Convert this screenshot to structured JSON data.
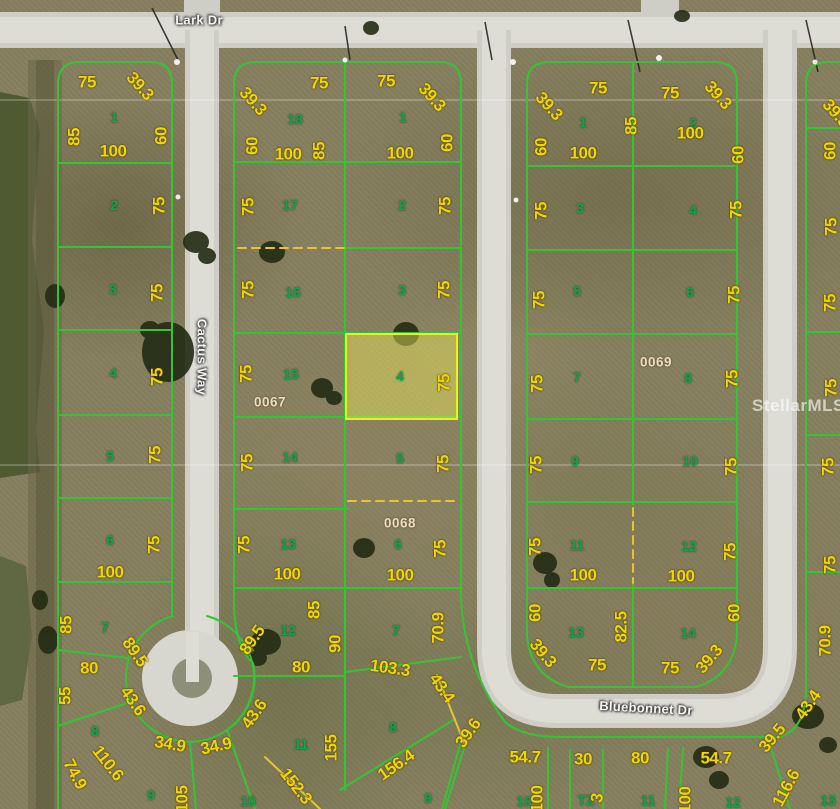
{
  "map": {
    "description": "Aerial parcel plat map with lot boundaries and dimensions",
    "colors": {
      "lot_line": "#35c435",
      "dimension_text": "#f2d600",
      "lot_number_text": "#0fa352",
      "road": "#d8d7cf",
      "dashed_line": "#e8c52e",
      "highlight_fill": "rgba(235,233,90,0.45)",
      "highlight_border": "#eeee22",
      "terrain": "#87805f",
      "water": "#4f5a33"
    },
    "streets": [
      {
        "text": "Lark Dr",
        "x": 199,
        "y": 20,
        "rot": 0
      },
      {
        "text": "Cactus Way",
        "x": 202,
        "y": 357,
        "rot": 90
      },
      {
        "text": "Bluebonnet Dr",
        "x": 646,
        "y": 708,
        "rot": 3
      }
    ],
    "block_ids": [
      {
        "text": "0067",
        "x": 270,
        "y": 402
      },
      {
        "text": "0068",
        "x": 400,
        "y": 523
      },
      {
        "text": "0069",
        "x": 656,
        "y": 362
      }
    ],
    "watermark": {
      "text": "StellarMLS",
      "x": 752,
      "y": 406
    },
    "highlight": {
      "lot": "4",
      "x": 345,
      "y": 333,
      "w": 113,
      "h": 87
    },
    "lot_numbers": [
      {
        "text": "1",
        "x": 114,
        "y": 117
      },
      {
        "text": "2",
        "x": 114,
        "y": 205
      },
      {
        "text": "3",
        "x": 113,
        "y": 289
      },
      {
        "text": "4",
        "x": 113,
        "y": 373
      },
      {
        "text": "5",
        "x": 110,
        "y": 456
      },
      {
        "text": "6",
        "x": 110,
        "y": 540
      },
      {
        "text": "7",
        "x": 105,
        "y": 627
      },
      {
        "text": "8",
        "x": 95,
        "y": 731
      },
      {
        "text": "9",
        "x": 151,
        "y": 795
      },
      {
        "text": "10",
        "x": 248,
        "y": 801
      },
      {
        "text": "18",
        "x": 295,
        "y": 119
      },
      {
        "text": "17",
        "x": 290,
        "y": 205
      },
      {
        "text": "16",
        "x": 293,
        "y": 292
      },
      {
        "text": "15",
        "x": 291,
        "y": 374
      },
      {
        "text": "14",
        "x": 290,
        "y": 457
      },
      {
        "text": "13",
        "x": 288,
        "y": 544
      },
      {
        "text": "12",
        "x": 288,
        "y": 630
      },
      {
        "text": "11",
        "x": 301,
        "y": 744
      },
      {
        "text": "1",
        "x": 403,
        "y": 117
      },
      {
        "text": "2",
        "x": 402,
        "y": 205
      },
      {
        "text": "3",
        "x": 402,
        "y": 290
      },
      {
        "text": "4",
        "x": 400,
        "y": 376
      },
      {
        "text": "5",
        "x": 400,
        "y": 458
      },
      {
        "text": "6",
        "x": 398,
        "y": 544
      },
      {
        "text": "7",
        "x": 396,
        "y": 630
      },
      {
        "text": "8",
        "x": 393,
        "y": 727
      },
      {
        "text": "1",
        "x": 583,
        "y": 122
      },
      {
        "text": "2",
        "x": 693,
        "y": 123
      },
      {
        "text": "3",
        "x": 580,
        "y": 208
      },
      {
        "text": "4",
        "x": 693,
        "y": 210
      },
      {
        "text": "5",
        "x": 577,
        "y": 291
      },
      {
        "text": "6",
        "x": 690,
        "y": 292
      },
      {
        "text": "7",
        "x": 577,
        "y": 377
      },
      {
        "text": "8",
        "x": 688,
        "y": 378
      },
      {
        "text": "9",
        "x": 575,
        "y": 461
      },
      {
        "text": "10",
        "x": 690,
        "y": 461
      },
      {
        "text": "11",
        "x": 577,
        "y": 545
      },
      {
        "text": "12",
        "x": 689,
        "y": 546
      },
      {
        "text": "13",
        "x": 576,
        "y": 632
      },
      {
        "text": "14",
        "x": 688,
        "y": 633
      },
      {
        "text": "9",
        "x": 428,
        "y": 798
      },
      {
        "text": "10",
        "x": 524,
        "y": 801
      },
      {
        "text": "TZ",
        "x": 586,
        "y": 800
      },
      {
        "text": "11",
        "x": 648,
        "y": 800
      },
      {
        "text": "12",
        "x": 733,
        "y": 802
      },
      {
        "text": "13",
        "x": 828,
        "y": 800
      }
    ],
    "dimensions": [
      {
        "text": "75",
        "x": 87,
        "y": 82,
        "rot": 0
      },
      {
        "text": "39.3",
        "x": 140,
        "y": 86,
        "rot": 48
      },
      {
        "text": "85",
        "x": 74,
        "y": 137,
        "rot": -90
      },
      {
        "text": "100",
        "x": 113,
        "y": 151,
        "rot": 0
      },
      {
        "text": "60",
        "x": 161,
        "y": 136,
        "rot": -90
      },
      {
        "text": "75",
        "x": 159,
        "y": 206,
        "rot": -90
      },
      {
        "text": "75",
        "x": 157,
        "y": 293,
        "rot": -90
      },
      {
        "text": "75",
        "x": 157,
        "y": 377,
        "rot": -90
      },
      {
        "text": "75",
        "x": 155,
        "y": 455,
        "rot": -90
      },
      {
        "text": "75",
        "x": 154,
        "y": 545,
        "rot": -90
      },
      {
        "text": "100",
        "x": 110,
        "y": 572,
        "rot": 0
      },
      {
        "text": "85",
        "x": 66,
        "y": 625,
        "rot": -90
      },
      {
        "text": "80",
        "x": 89,
        "y": 668,
        "rot": 0
      },
      {
        "text": "89.5",
        "x": 135,
        "y": 652,
        "rot": 55
      },
      {
        "text": "89.5",
        "x": 252,
        "y": 640,
        "rot": -55
      },
      {
        "text": "55",
        "x": 65,
        "y": 696,
        "rot": -90
      },
      {
        "text": "43.6",
        "x": 133,
        "y": 701,
        "rot": 55
      },
      {
        "text": "43.6",
        "x": 254,
        "y": 714,
        "rot": -55
      },
      {
        "text": "74.9",
        "x": 75,
        "y": 774,
        "rot": 62
      },
      {
        "text": "110.6",
        "x": 108,
        "y": 763,
        "rot": 52
      },
      {
        "text": "34.9",
        "x": 170,
        "y": 744,
        "rot": 10
      },
      {
        "text": "34.9",
        "x": 216,
        "y": 746,
        "rot": -12
      },
      {
        "text": "105",
        "x": 182,
        "y": 799,
        "rot": -90
      },
      {
        "text": "39.3",
        "x": 253,
        "y": 101,
        "rot": 48
      },
      {
        "text": "75",
        "x": 319,
        "y": 83,
        "rot": 0
      },
      {
        "text": "75",
        "x": 386,
        "y": 81,
        "rot": 0
      },
      {
        "text": "39.3",
        "x": 432,
        "y": 97,
        "rot": 48
      },
      {
        "text": "60",
        "x": 252,
        "y": 146,
        "rot": -90
      },
      {
        "text": "100",
        "x": 288,
        "y": 154,
        "rot": 0
      },
      {
        "text": "85",
        "x": 319,
        "y": 151,
        "rot": -90
      },
      {
        "text": "100",
        "x": 400,
        "y": 153,
        "rot": 0
      },
      {
        "text": "60",
        "x": 447,
        "y": 143,
        "rot": -90
      },
      {
        "text": "75",
        "x": 248,
        "y": 207,
        "rot": -90
      },
      {
        "text": "75",
        "x": 445,
        "y": 206,
        "rot": -90
      },
      {
        "text": "75",
        "x": 248,
        "y": 290,
        "rot": -90
      },
      {
        "text": "75",
        "x": 444,
        "y": 290,
        "rot": -90
      },
      {
        "text": "75",
        "x": 246,
        "y": 374,
        "rot": -90
      },
      {
        "text": "75",
        "x": 444,
        "y": 383,
        "rot": -90
      },
      {
        "text": "75",
        "x": 247,
        "y": 463,
        "rot": -90
      },
      {
        "text": "75",
        "x": 443,
        "y": 464,
        "rot": -90
      },
      {
        "text": "75",
        "x": 244,
        "y": 545,
        "rot": -90
      },
      {
        "text": "75",
        "x": 440,
        "y": 549,
        "rot": -90
      },
      {
        "text": "100",
        "x": 287,
        "y": 574,
        "rot": 0
      },
      {
        "text": "100",
        "x": 400,
        "y": 575,
        "rot": 0
      },
      {
        "text": "85",
        "x": 314,
        "y": 610,
        "rot": -90
      },
      {
        "text": "90",
        "x": 335,
        "y": 644,
        "rot": -90
      },
      {
        "text": "80",
        "x": 301,
        "y": 667,
        "rot": 0
      },
      {
        "text": "70.9",
        "x": 438,
        "y": 628,
        "rot": -90
      },
      {
        "text": "103.3",
        "x": 390,
        "y": 668,
        "rot": 8
      },
      {
        "text": "43.4",
        "x": 442,
        "y": 688,
        "rot": 55
      },
      {
        "text": "39.6",
        "x": 468,
        "y": 733,
        "rot": -55
      },
      {
        "text": "155",
        "x": 331,
        "y": 748,
        "rot": -90
      },
      {
        "text": "156.4",
        "x": 396,
        "y": 765,
        "rot": -35
      },
      {
        "text": "152.3",
        "x": 296,
        "y": 786,
        "rot": 52
      },
      {
        "text": "39.3",
        "x": 549,
        "y": 106,
        "rot": 48
      },
      {
        "text": "75",
        "x": 598,
        "y": 88,
        "rot": 0
      },
      {
        "text": "75",
        "x": 670,
        "y": 93,
        "rot": 0
      },
      {
        "text": "39.3",
        "x": 718,
        "y": 95,
        "rot": 48
      },
      {
        "text": "60",
        "x": 541,
        "y": 147,
        "rot": -90
      },
      {
        "text": "100",
        "x": 583,
        "y": 153,
        "rot": 0
      },
      {
        "text": "85",
        "x": 631,
        "y": 126,
        "rot": -90
      },
      {
        "text": "100",
        "x": 690,
        "y": 133,
        "rot": 0
      },
      {
        "text": "60",
        "x": 738,
        "y": 155,
        "rot": -90
      },
      {
        "text": "75",
        "x": 541,
        "y": 211,
        "rot": -90
      },
      {
        "text": "75",
        "x": 736,
        "y": 210,
        "rot": -90
      },
      {
        "text": "75",
        "x": 539,
        "y": 300,
        "rot": -90
      },
      {
        "text": "75",
        "x": 734,
        "y": 295,
        "rot": -90
      },
      {
        "text": "75",
        "x": 537,
        "y": 384,
        "rot": -90
      },
      {
        "text": "75",
        "x": 732,
        "y": 379,
        "rot": -90
      },
      {
        "text": "75",
        "x": 536,
        "y": 465,
        "rot": -90
      },
      {
        "text": "75",
        "x": 731,
        "y": 467,
        "rot": -90
      },
      {
        "text": "75",
        "x": 535,
        "y": 547,
        "rot": -90
      },
      {
        "text": "75",
        "x": 730,
        "y": 552,
        "rot": -90
      },
      {
        "text": "100",
        "x": 583,
        "y": 575,
        "rot": 0
      },
      {
        "text": "100",
        "x": 681,
        "y": 576,
        "rot": 0
      },
      {
        "text": "60",
        "x": 535,
        "y": 613,
        "rot": -90
      },
      {
        "text": "82.5",
        "x": 621,
        "y": 627,
        "rot": -90
      },
      {
        "text": "60",
        "x": 734,
        "y": 613,
        "rot": -90
      },
      {
        "text": "39.3",
        "x": 543,
        "y": 653,
        "rot": 50
      },
      {
        "text": "75",
        "x": 597,
        "y": 665,
        "rot": 0
      },
      {
        "text": "75",
        "x": 670,
        "y": 668,
        "rot": 0
      },
      {
        "text": "39.3",
        "x": 709,
        "y": 659,
        "rot": -50
      },
      {
        "text": "54.7",
        "x": 525,
        "y": 757,
        "rot": 0
      },
      {
        "text": "30",
        "x": 583,
        "y": 759,
        "rot": 0
      },
      {
        "text": "80",
        "x": 640,
        "y": 758,
        "rot": 0
      },
      {
        "text": "54.7",
        "x": 716,
        "y": 758,
        "rot": 0
      },
      {
        "text": "100",
        "x": 537,
        "y": 799,
        "rot": -90
      },
      {
        "text": "100",
        "x": 685,
        "y": 800,
        "rot": -90
      },
      {
        "text": "3",
        "x": 597,
        "y": 798,
        "rot": -80
      },
      {
        "text": "39.5",
        "x": 772,
        "y": 738,
        "rot": -50
      },
      {
        "text": "43.4",
        "x": 808,
        "y": 705,
        "rot": -55
      },
      {
        "text": "116.6",
        "x": 786,
        "y": 788,
        "rot": -62
      },
      {
        "text": "70.9",
        "x": 825,
        "y": 641,
        "rot": -90
      },
      {
        "text": "39.3",
        "x": 836,
        "y": 113,
        "rot": 48
      },
      {
        "text": "60",
        "x": 830,
        "y": 151,
        "rot": -90
      },
      {
        "text": "75",
        "x": 831,
        "y": 227,
        "rot": -90
      },
      {
        "text": "75",
        "x": 830,
        "y": 303,
        "rot": -90
      },
      {
        "text": "75",
        "x": 831,
        "y": 388,
        "rot": -90
      },
      {
        "text": "75",
        "x": 828,
        "y": 467,
        "rot": -90
      },
      {
        "text": "75",
        "x": 830,
        "y": 565,
        "rot": -90
      }
    ]
  }
}
